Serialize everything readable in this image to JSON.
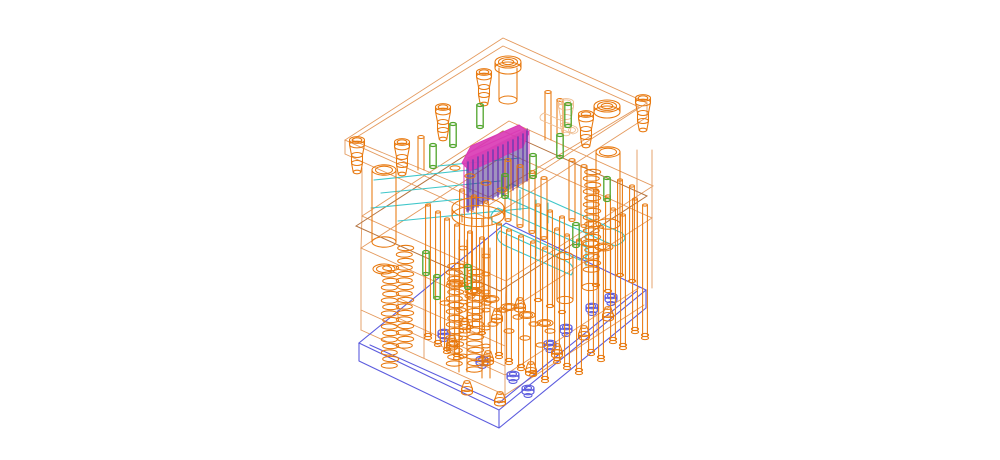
{
  "canvas": {
    "width": 1000,
    "height": 460,
    "background": "#FFFFFF"
  },
  "colors": {
    "frame": "#E49A5E",
    "frame_light": "#EFBE92",
    "frame_dark": "#B57440",
    "orange": "#E8790F",
    "blue": "#5C5CDE",
    "cyan": "#3EC6C9",
    "magenta": "#DA3CB5",
    "purple": "#6B3BB0",
    "purple_dark": "#41257F",
    "green": "#50A52C"
  },
  "components": {
    "guide_bushings": [
      [
        357,
        140
      ],
      [
        402,
        142
      ],
      [
        443,
        107
      ],
      [
        484,
        72
      ],
      [
        586,
        114
      ],
      [
        643,
        98
      ]
    ],
    "light_bushings": [
      [
        566,
        102
      ]
    ],
    "ring_bushings": [
      [
        508,
        62
      ],
      [
        607,
        106
      ]
    ],
    "guide_pillars": [
      [
        384,
        170
      ],
      [
        608,
        152
      ]
    ],
    "springs": [
      [
        405,
        248
      ],
      [
        455,
        266
      ],
      [
        475,
        272
      ],
      [
        390,
        268
      ],
      [
        592,
        172
      ]
    ],
    "ejector_pins_long": [
      [
        428,
        205
      ],
      [
        438,
        212
      ],
      [
        447,
        219
      ],
      [
        457,
        225
      ],
      [
        499,
        224
      ],
      [
        509,
        230
      ],
      [
        521,
        236
      ],
      [
        533,
        242
      ],
      [
        545,
        248
      ],
      [
        557,
        229
      ],
      [
        567,
        235
      ],
      [
        579,
        240
      ],
      [
        591,
        221
      ],
      [
        601,
        227
      ],
      [
        613,
        209
      ],
      [
        623,
        215
      ],
      [
        635,
        199
      ],
      [
        645,
        205
      ]
    ],
    "ejector_pins_mid": [
      [
        470,
        232
      ],
      [
        482,
        238
      ],
      [
        462,
        190
      ],
      [
        474,
        196
      ],
      [
        486,
        202
      ],
      [
        538,
        205
      ],
      [
        550,
        211
      ],
      [
        562,
        217
      ],
      [
        596,
        190
      ],
      [
        608,
        196
      ],
      [
        620,
        180
      ],
      [
        632,
        186
      ]
    ],
    "ejector_pins_short": [
      [
        508,
        160
      ],
      [
        520,
        166
      ],
      [
        532,
        172
      ],
      [
        544,
        178
      ],
      [
        572,
        160
      ],
      [
        584,
        166
      ]
    ],
    "pin_feet": [
      [
        452,
        337
      ],
      [
        467,
        382
      ],
      [
        488,
        352
      ],
      [
        500,
        393
      ],
      [
        531,
        363
      ],
      [
        557,
        345
      ],
      [
        584,
        327
      ],
      [
        608,
        308
      ],
      [
        497,
        310
      ],
      [
        520,
        299
      ],
      [
        465,
        320
      ]
    ],
    "pin_heads": [
      [
        445,
        303
      ],
      [
        461,
        310
      ],
      [
        477,
        317
      ],
      [
        493,
        324
      ],
      [
        509,
        331
      ],
      [
        525,
        338
      ],
      [
        470,
        296
      ],
      [
        486,
        303
      ],
      [
        502,
        310
      ],
      [
        518,
        317
      ],
      [
        534,
        324
      ],
      [
        550,
        331
      ],
      [
        541,
        345
      ],
      [
        557,
        352
      ],
      [
        470,
        176
      ],
      [
        486,
        183
      ],
      [
        502,
        190
      ],
      [
        455,
        168
      ],
      [
        454,
        343
      ],
      [
        486,
        357
      ]
    ],
    "retainer_bores": [
      [
        455,
        283
      ],
      [
        473,
        291
      ],
      [
        491,
        299
      ],
      [
        509,
        307
      ],
      [
        527,
        315
      ],
      [
        545,
        323
      ]
    ],
    "cap_screws": [
      [
        444,
        332
      ],
      [
        482,
        359
      ],
      [
        513,
        374
      ],
      [
        528,
        388
      ],
      [
        550,
        343
      ],
      [
        566,
        327
      ],
      [
        592,
        306
      ],
      [
        611,
        296
      ]
    ],
    "dowel_pins": [
      [
        480,
        105
      ],
      [
        453,
        124
      ],
      [
        433,
        145
      ],
      [
        426,
        252
      ],
      [
        437,
        276
      ],
      [
        468,
        266
      ],
      [
        505,
        175
      ],
      [
        533,
        155
      ],
      [
        560,
        135
      ],
      [
        576,
        224
      ],
      [
        607,
        178
      ],
      [
        568,
        104
      ]
    ],
    "column_bands": [
      [
        463,
        248
      ],
      [
        463,
        266
      ],
      [
        463,
        284
      ],
      [
        463,
        302
      ],
      [
        463,
        320
      ],
      [
        463,
        338
      ],
      [
        463,
        356
      ],
      [
        486,
        256
      ],
      [
        486,
        274
      ],
      [
        486,
        292
      ],
      [
        486,
        310
      ],
      [
        486,
        328
      ],
      [
        486,
        346
      ],
      [
        486,
        364
      ]
    ]
  }
}
